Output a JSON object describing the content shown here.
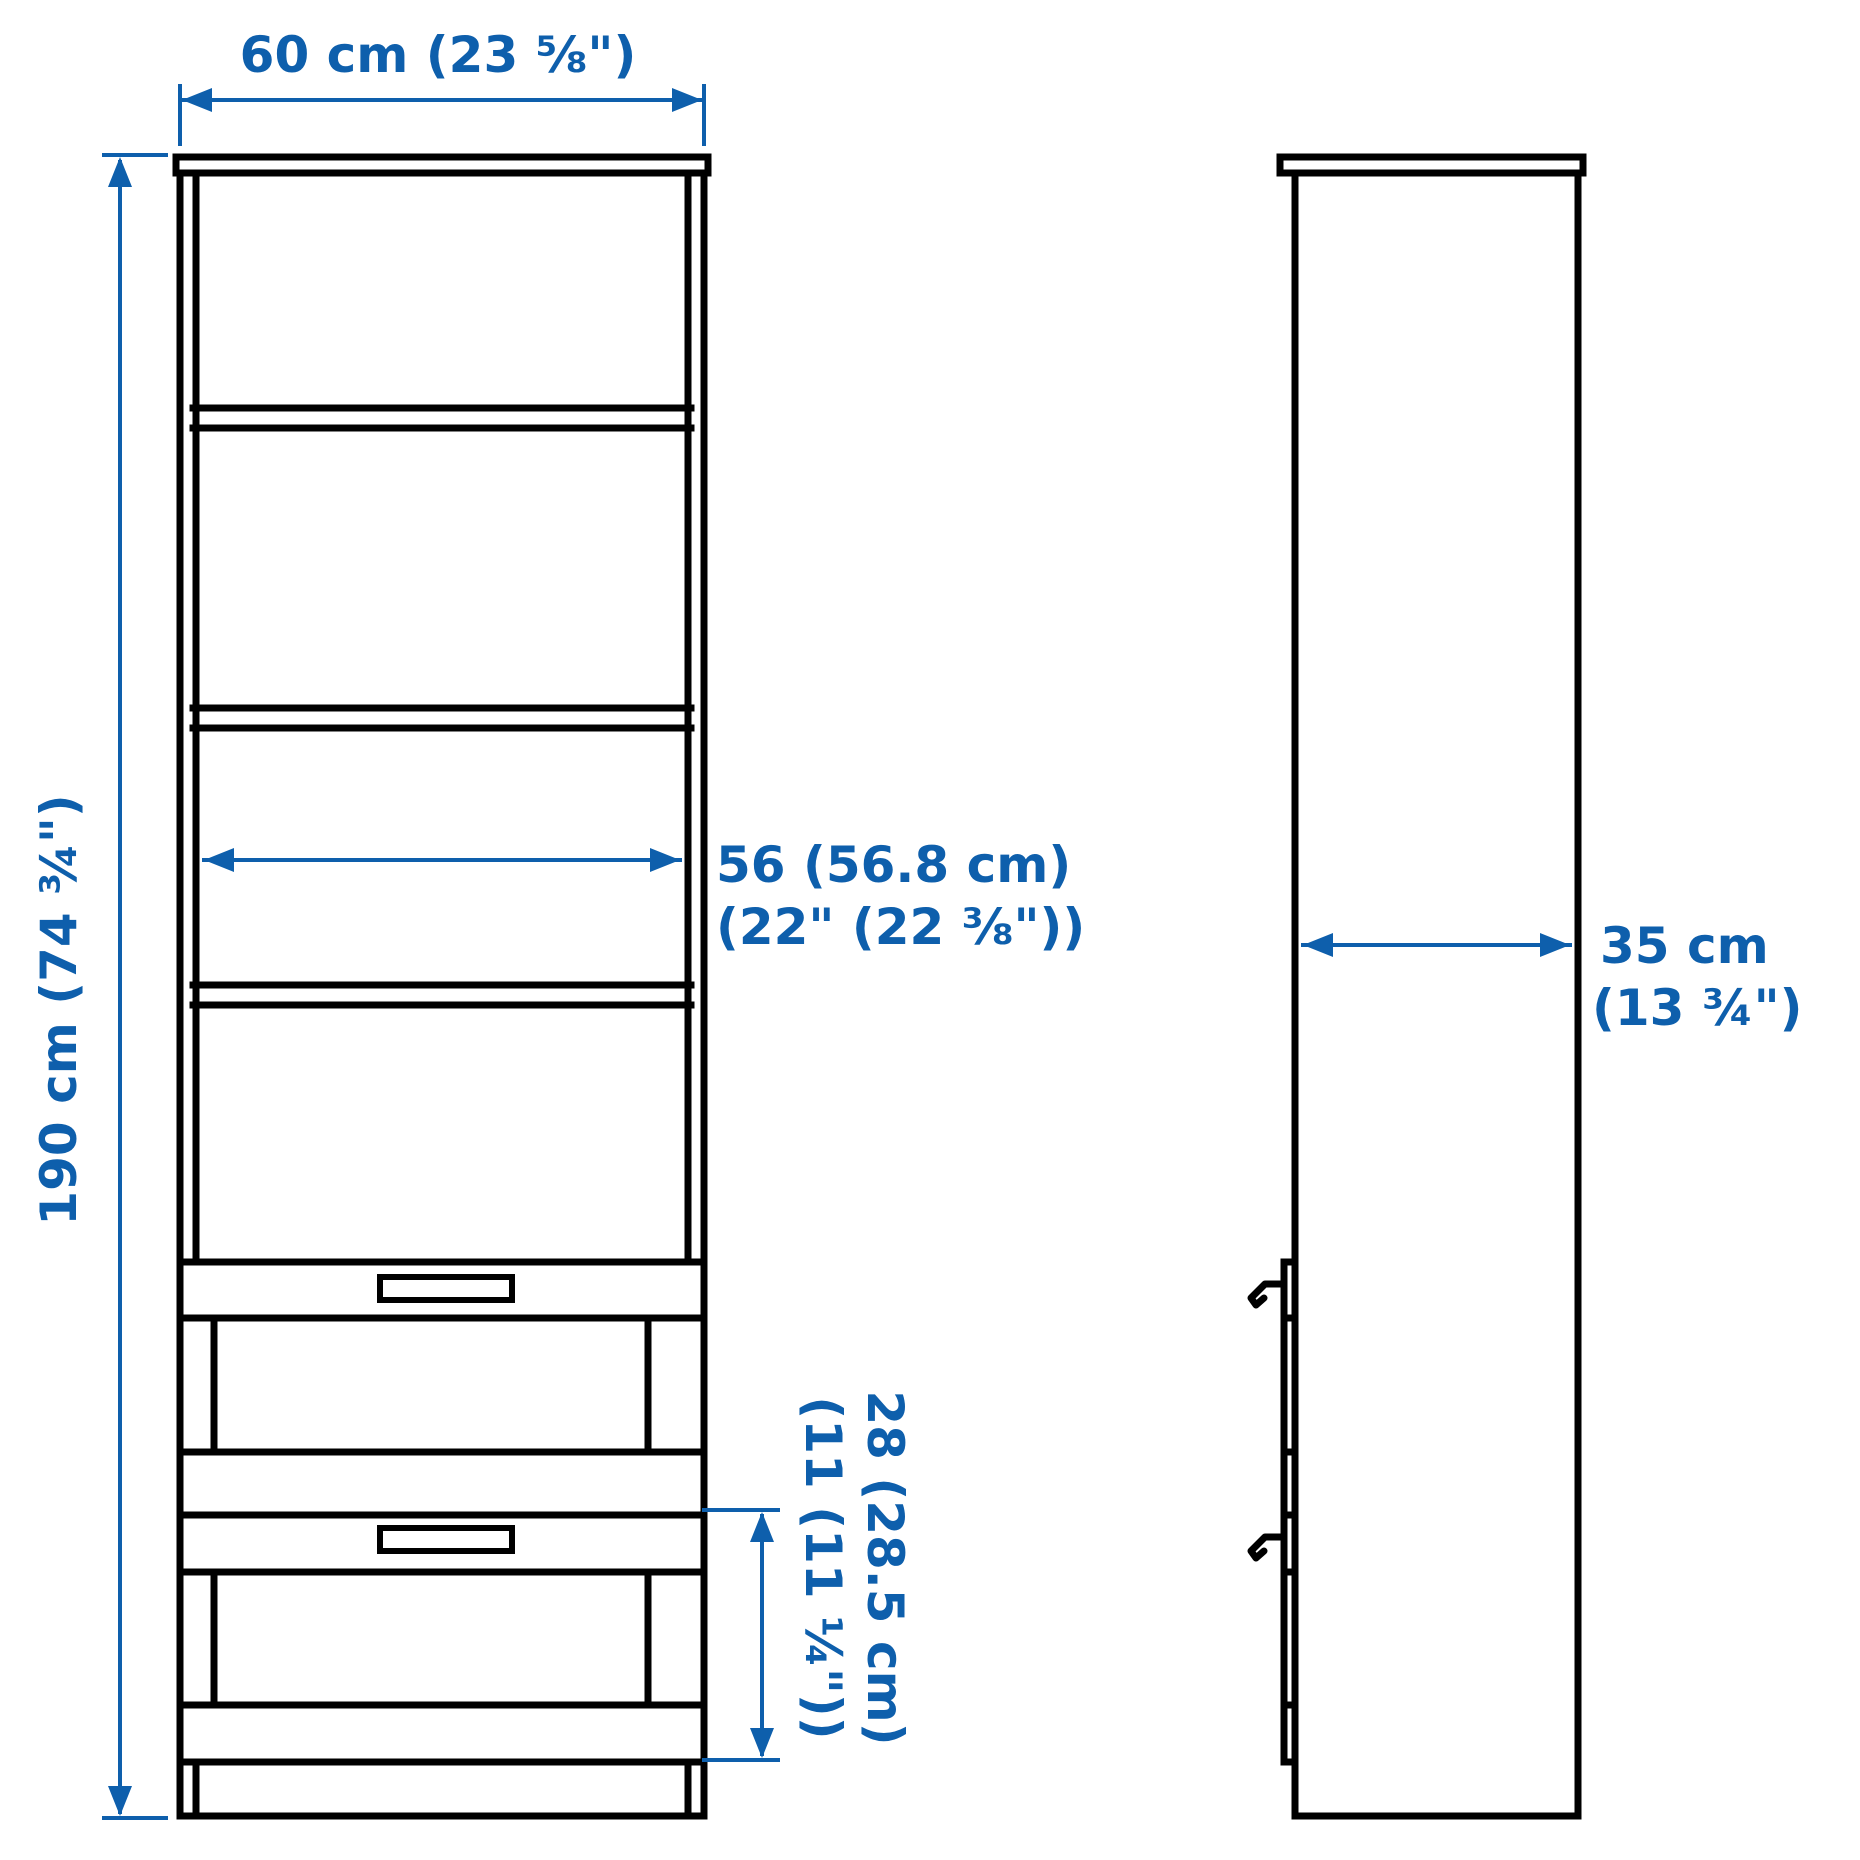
{
  "diagram": {
    "title": "wardrobe-dimension-drawing",
    "style": "ikea-line-drawing",
    "views": {
      "front": "front elevation with 4 open shelf compartments and 2 drawers with handles on a plinth",
      "side": "side elevation with protruding drawer fronts and two hook handles"
    }
  },
  "colors": {
    "dimension_blue": "#0E5FAC",
    "line_black": "#000000",
    "background": "#FFFFFF"
  },
  "dimensions": {
    "overall_width": {
      "text": "60 cm (23 ⅝\")"
    },
    "overall_height": {
      "text": "190 cm (74 ¾\")"
    },
    "interior_width": {
      "line1": "56 (56.8 cm)",
      "line2": "(22\" (22 ⅜\"))"
    },
    "drawer_front_height": {
      "line1": "28 (28.5 cm)",
      "line2": "(11 (11 ¼\"))"
    },
    "overall_depth": {
      "line1": "35 cm",
      "line2": "(13 ¾\")"
    }
  }
}
